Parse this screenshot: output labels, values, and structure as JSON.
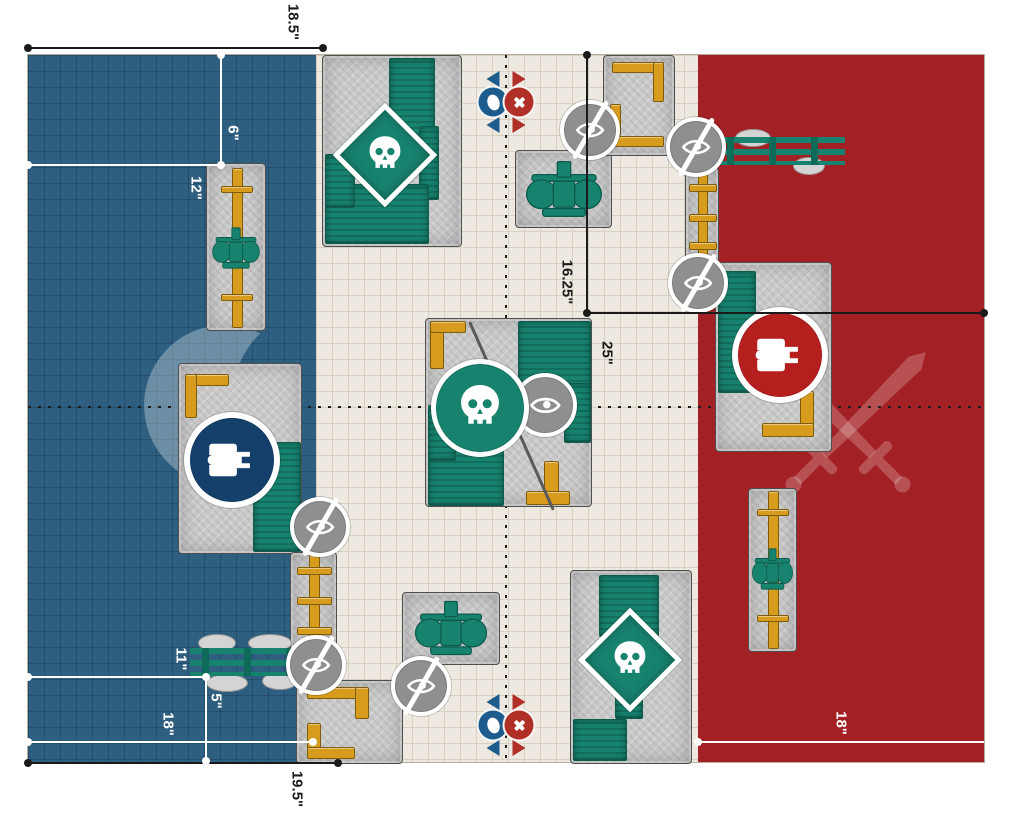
{
  "title": "battlefield-deployment-map",
  "colors": {
    "field": "#EDE9E0",
    "field_grid": "#D8D1C2",
    "blue_zone": "#2E5F80",
    "red_zone": "#A32125",
    "terrain_teal": "#17826E",
    "terrain_gold": "#D79B1E",
    "tank_blue": "#14406B",
    "tank_red": "#B5201F",
    "marker_blue": "#1D5C8C",
    "marker_red": "#B03028",
    "icon_gray": "#8F8F8F"
  },
  "measurements": {
    "top_width": {
      "label": "18.5\""
    },
    "left_upper_v": {
      "label": "6\""
    },
    "left_upper_h": {
      "label": "12\""
    },
    "center_v": {
      "label": "16.25\""
    },
    "center_h": {
      "label": "25\""
    },
    "left_lower_h1": {
      "label": "11\""
    },
    "left_lower_v": {
      "label": "5\""
    },
    "left_lower_h2": {
      "label": "18\""
    },
    "bottom_width": {
      "label": "19.5\""
    },
    "right_lower_h": {
      "label": "18\""
    }
  },
  "zones": [
    {
      "name": "blue-deployment-zone",
      "watermark": "crescent-moon"
    },
    {
      "name": "red-deployment-zone",
      "watermark": "crossed-swords"
    }
  ],
  "terrain": [
    {
      "name": "pipeline-ruin-left",
      "x": 178,
      "y": 108,
      "w": 58,
      "h": 166,
      "decos": [
        {
          "k": "gold",
          "x": 25,
          "y": 4,
          "w": 9,
          "h": 158
        },
        {
          "k": "gold",
          "x": 14,
          "y": 22,
          "w": 30,
          "h": 5
        },
        {
          "k": "gold",
          "x": 14,
          "y": 130,
          "w": 30,
          "h": 5
        },
        {
          "k": "machine",
          "x": 4,
          "y": 62,
          "w": 50,
          "h": 44
        }
      ]
    },
    {
      "name": "ruins-top-middle",
      "x": 294,
      "y": 0,
      "w": 138,
      "h": 190,
      "decos": [
        {
          "k": "teal",
          "x": 66,
          "y": 2,
          "w": 44,
          "h": 112
        },
        {
          "k": "teal",
          "x": 96,
          "y": 70,
          "w": 18,
          "h": 72
        },
        {
          "k": "teal",
          "x": 2,
          "y": 128,
          "w": 102,
          "h": 58
        },
        {
          "k": "teal",
          "x": 2,
          "y": 98,
          "w": 28,
          "h": 52
        }
      ]
    },
    {
      "name": "machinery-ruin-top-center",
      "x": 487,
      "y": 95,
      "w": 95,
      "h": 76,
      "decos": [
        {
          "k": "machine",
          "x": 8,
          "y": 8,
          "w": 80,
          "h": 60
        }
      ]
    },
    {
      "name": "ruins-top-right",
      "x": 575,
      "y": 0,
      "w": 70,
      "h": 99,
      "decos": [
        {
          "k": "gold",
          "x": 8,
          "y": 6,
          "w": 50,
          "h": 9
        },
        {
          "k": "gold",
          "x": 49,
          "y": 6,
          "w": 9,
          "h": 38
        },
        {
          "k": "gold",
          "x": 6,
          "y": 48,
          "w": 9,
          "h": 30
        },
        {
          "k": "gold",
          "x": 6,
          "y": 80,
          "w": 52,
          "h": 9
        }
      ]
    },
    {
      "name": "pipes-right-upper",
      "x": 657,
      "y": 112,
      "w": 32,
      "h": 98,
      "decos": [
        {
          "k": "gold",
          "x": 12,
          "y": 2,
          "w": 8,
          "h": 94
        },
        {
          "k": "gold",
          "x": 3,
          "y": 16,
          "w": 26,
          "h": 6
        },
        {
          "k": "gold",
          "x": 3,
          "y": 46,
          "w": 26,
          "h": 6
        },
        {
          "k": "gold",
          "x": 3,
          "y": 74,
          "w": 26,
          "h": 6
        }
      ]
    },
    {
      "name": "bridge-right",
      "x": 687,
      "y": 82,
      "w": 130,
      "h": 28,
      "variant": "bridge",
      "decos": [
        {
          "k": "rock",
          "x": 20,
          "y": -8,
          "w": 34,
          "h": 16
        },
        {
          "k": "rock",
          "x": 78,
          "y": 20,
          "w": 30,
          "h": 16
        },
        {
          "k": "rails",
          "x": 0,
          "y": 0,
          "w": 130,
          "h": 28
        }
      ]
    },
    {
      "name": "ruins-right-center",
      "x": 687,
      "y": 207,
      "w": 115,
      "h": 188,
      "decos": [
        {
          "k": "teal",
          "x": 2,
          "y": 8,
          "w": 36,
          "h": 120
        },
        {
          "k": "gold",
          "x": 84,
          "y": 128,
          "w": 12,
          "h": 44
        },
        {
          "k": "gold",
          "x": 46,
          "y": 160,
          "w": 50,
          "h": 12
        }
      ]
    },
    {
      "name": "ruins-center",
      "x": 397,
      "y": 263,
      "w": 165,
      "h": 187,
      "decos": [
        {
          "k": "gold",
          "x": 4,
          "y": 2,
          "w": 12,
          "h": 46
        },
        {
          "k": "gold",
          "x": 4,
          "y": 2,
          "w": 34,
          "h": 10
        },
        {
          "k": "teal",
          "x": 92,
          "y": 2,
          "w": 71,
          "h": 72
        },
        {
          "k": "teal",
          "x": 138,
          "y": 64,
          "w": 25,
          "h": 58
        },
        {
          "k": "teal",
          "x": 2,
          "y": 112,
          "w": 74,
          "h": 73
        },
        {
          "k": "teal",
          "x": 2,
          "y": 86,
          "w": 26,
          "h": 54
        },
        {
          "k": "gold",
          "x": 118,
          "y": 142,
          "w": 13,
          "h": 42
        },
        {
          "k": "gold",
          "x": 100,
          "y": 172,
          "w": 42,
          "h": 12
        },
        {
          "k": "crack",
          "x": 84,
          "y": -6,
          "w": 3,
          "h": 206
        }
      ]
    },
    {
      "name": "ruins-left-center",
      "x": 150,
      "y": 308,
      "w": 122,
      "h": 189,
      "decos": [
        {
          "k": "gold",
          "x": 6,
          "y": 10,
          "w": 42,
          "h": 10
        },
        {
          "k": "gold",
          "x": 6,
          "y": 10,
          "w": 10,
          "h": 42
        },
        {
          "k": "teal",
          "x": 74,
          "y": 78,
          "w": 46,
          "h": 108
        }
      ]
    },
    {
      "name": "pipes-left-lower",
      "x": 262,
      "y": 497,
      "w": 45,
      "h": 98,
      "decos": [
        {
          "k": "gold",
          "x": 18,
          "y": 2,
          "w": 9,
          "h": 94
        },
        {
          "k": "gold",
          "x": 6,
          "y": 14,
          "w": 33,
          "h": 6
        },
        {
          "k": "gold",
          "x": 6,
          "y": 44,
          "w": 33,
          "h": 6
        },
        {
          "k": "gold",
          "x": 6,
          "y": 74,
          "w": 33,
          "h": 6
        }
      ]
    },
    {
      "name": "bridge-left-bottom",
      "x": 162,
      "y": 585,
      "w": 120,
      "h": 45,
      "variant": "bridge",
      "decos": [
        {
          "k": "rock",
          "x": 8,
          "y": -6,
          "w": 36,
          "h": 16
        },
        {
          "k": "rock",
          "x": 58,
          "y": -6,
          "w": 42,
          "h": 16
        },
        {
          "k": "rock",
          "x": 16,
          "y": 34,
          "w": 40,
          "h": 16
        },
        {
          "k": "rock",
          "x": 72,
          "y": 32,
          "w": 34,
          "h": 16
        },
        {
          "k": "rails",
          "x": 0,
          "y": 8,
          "w": 120,
          "h": 28
        }
      ]
    },
    {
      "name": "ruins-bottom-center-left",
      "x": 268,
      "y": 625,
      "w": 105,
      "h": 82,
      "decos": [
        {
          "k": "gold",
          "x": 10,
          "y": 6,
          "w": 58,
          "h": 10
        },
        {
          "k": "gold",
          "x": 58,
          "y": 6,
          "w": 12,
          "h": 30
        },
        {
          "k": "gold",
          "x": 10,
          "y": 42,
          "w": 12,
          "h": 34
        },
        {
          "k": "gold",
          "x": 10,
          "y": 66,
          "w": 46,
          "h": 10
        }
      ]
    },
    {
      "name": "machinery-ruin-bottom-center",
      "x": 374,
      "y": 537,
      "w": 96,
      "h": 71,
      "decos": [
        {
          "k": "machine",
          "x": 10,
          "y": 6,
          "w": 76,
          "h": 58
        }
      ]
    },
    {
      "name": "ruins-bottom-right-center",
      "x": 542,
      "y": 515,
      "w": 120,
      "h": 192,
      "decos": [
        {
          "k": "teal",
          "x": 28,
          "y": 4,
          "w": 58,
          "h": 60
        },
        {
          "k": "teal",
          "x": 44,
          "y": 58,
          "w": 26,
          "h": 88
        },
        {
          "k": "teal",
          "x": 2,
          "y": 148,
          "w": 52,
          "h": 40
        }
      ]
    },
    {
      "name": "pipeline-ruin-right-bottom",
      "x": 720,
      "y": 433,
      "w": 47,
      "h": 162,
      "decos": [
        {
          "k": "gold",
          "x": 19,
          "y": 2,
          "w": 9,
          "h": 156
        },
        {
          "k": "gold",
          "x": 8,
          "y": 20,
          "w": 30,
          "h": 5
        },
        {
          "k": "gold",
          "x": 8,
          "y": 126,
          "w": 30,
          "h": 5
        },
        {
          "k": "machine",
          "x": 2,
          "y": 58,
          "w": 43,
          "h": 44
        }
      ]
    }
  ],
  "icons": [
    {
      "type": "no-line-of-sight",
      "cx": 562,
      "cy": 75
    },
    {
      "type": "no-line-of-sight",
      "cx": 668,
      "cy": 92
    },
    {
      "type": "no-line-of-sight",
      "cx": 670,
      "cy": 228
    },
    {
      "type": "no-line-of-sight",
      "cx": 292,
      "cy": 472
    },
    {
      "type": "no-line-of-sight",
      "cx": 288,
      "cy": 610
    },
    {
      "type": "no-line-of-sight",
      "cx": 393,
      "cy": 631
    },
    {
      "type": "eye",
      "cx": 517,
      "cy": 350
    },
    {
      "type": "objective-skull-circle",
      "cx": 452,
      "cy": 353
    },
    {
      "type": "objective-skull-diamond",
      "cx": 357,
      "cy": 100
    },
    {
      "type": "objective-skull-diamond",
      "cx": 602,
      "cy": 605
    },
    {
      "type": "objective-tank-blue",
      "cx": 204,
      "cy": 405
    },
    {
      "type": "objective-tank-red",
      "cx": 752,
      "cy": 300
    }
  ],
  "markers": [
    {
      "name": "deployment-marker-pair-top",
      "cx": 478,
      "cy": 47
    },
    {
      "name": "deployment-marker-pair-bottom",
      "cx": 478,
      "cy": 670
    }
  ]
}
